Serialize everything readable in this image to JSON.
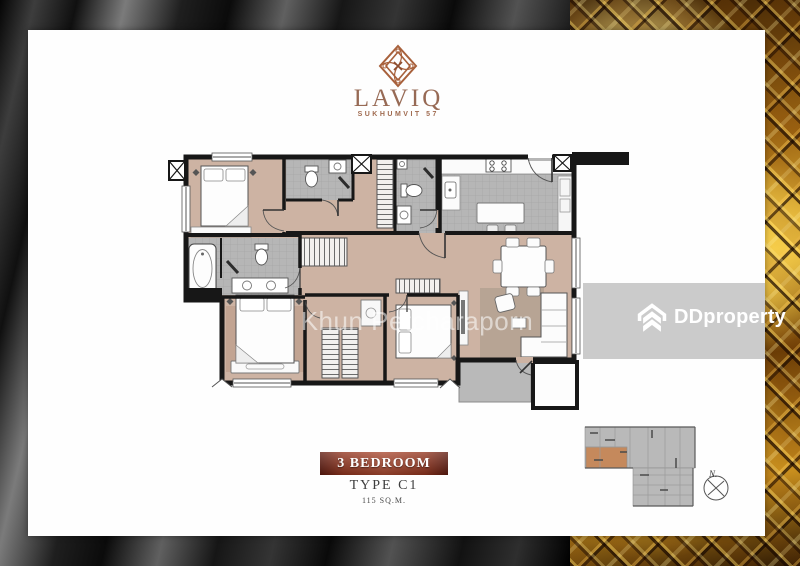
{
  "branding": {
    "name": "LAVIQ",
    "subtitle": "SUKHUMVIT 57",
    "emblem_icon": "diamond-knot-icon",
    "accent_color": "#a8613c"
  },
  "watermark": {
    "agent_name": "Khun Petcharaporn"
  },
  "portal": {
    "logo_text": "DDproperty",
    "logo_icon": "double-chevron-house-icon",
    "band_color": "#c8c8c8",
    "logo_color": "#ffffff"
  },
  "unit": {
    "banner_label": "3 BEDROOM",
    "type_label": "TYPE C1",
    "area_label": "115 SQ.M.",
    "banner_color": "#9a3b27"
  },
  "key_plan": {
    "north_label": "N.",
    "compass_icon": "compass-icon",
    "building_color": "#b9b9b9",
    "highlight_unit_color": "#c5895c"
  },
  "floor_plan": {
    "kind": "3-bedroom condominium unit plan",
    "colors": {
      "floor": "#cdb3a3",
      "bath_kitchen_tile": "#b6b6b6",
      "wall": "#171717",
      "rug": "#b7a494",
      "balcony": "#b9b9b9"
    }
  },
  "background": {
    "left_texture": "dark-curtain",
    "right_texture": "gold-ornate-lattice"
  }
}
